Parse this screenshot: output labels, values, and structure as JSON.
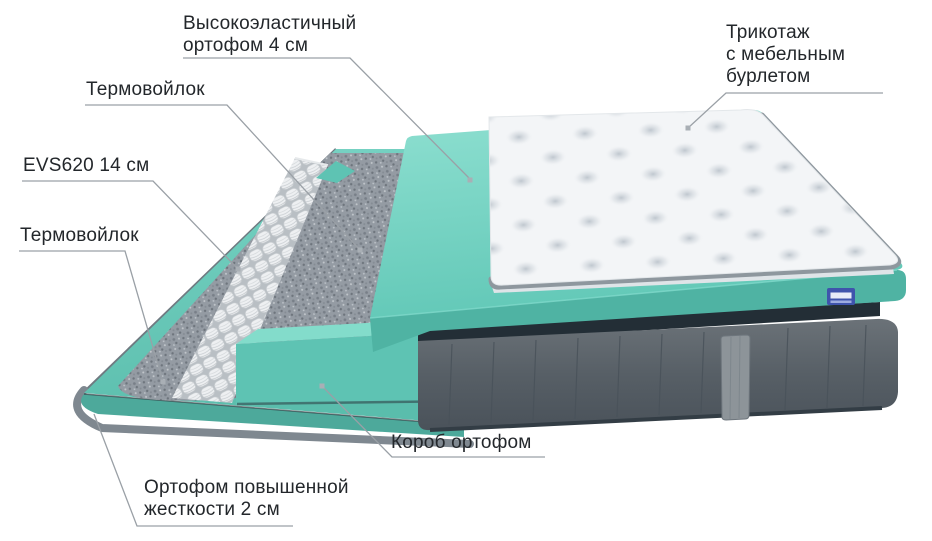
{
  "diagram": {
    "background": "#ffffff",
    "text_color": "#23272b",
    "leader_color": "#9aa0a6",
    "leader_dot_color": "#a9afb5",
    "labels": {
      "elastic_foam": {
        "line1": "Высокоэластичный",
        "line2": "ортофом 4 см"
      },
      "thermo_felt_top": {
        "text": "Термовойлок"
      },
      "spring_block": {
        "text": "EVS620 14 см"
      },
      "thermo_felt_bottom": {
        "text": "Термовойлок"
      },
      "knit_cover": {
        "line1": "Трикотаж",
        "line2": "с мебельным",
        "line3": "бурлетом"
      },
      "foam_box": {
        "text": "Короб ортофом"
      },
      "rigid_foam": {
        "line1": "Ортофом повышенной",
        "line2": "жесткости 2 см"
      }
    },
    "colors": {
      "foam_base_top": "#6cc9ba",
      "foam_base_front": "#4da99b",
      "foam_box_front": "#5ec3b3",
      "foam_box_top": "#83dccb",
      "elastic_foam_front": "#4fb3a3",
      "felt_gray": "#949ba3",
      "spring_white": "#eef0f2",
      "side_fabric": "#5b646b",
      "piping_dark": "#232e36",
      "handle_gray": "#8d9499",
      "quilt_white": "#f3f5f7",
      "quilt_piping": "#8e979e",
      "badge_blue": "#3f54ac"
    }
  }
}
